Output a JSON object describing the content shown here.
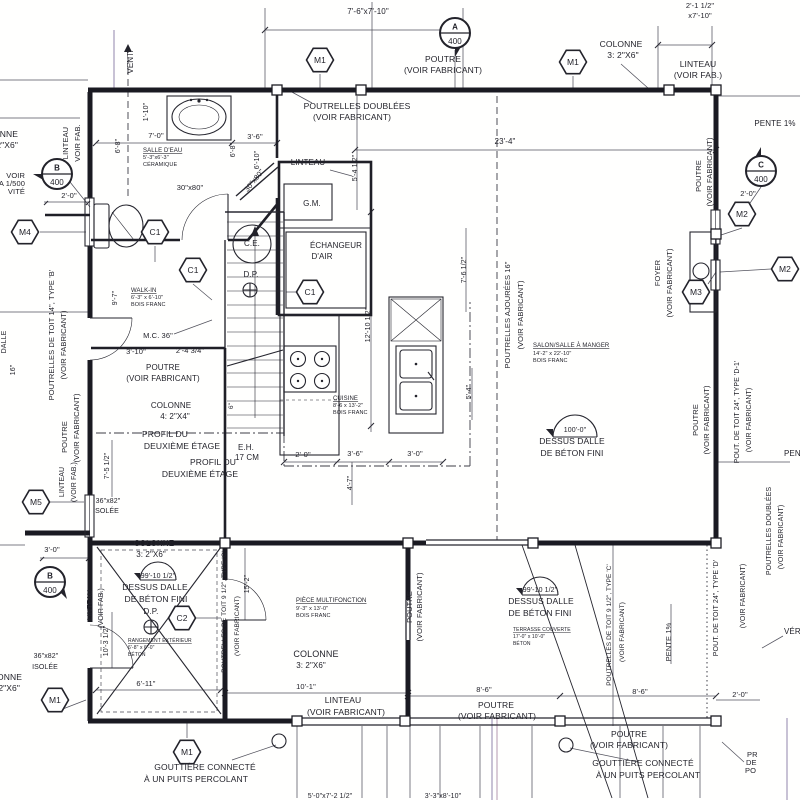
{
  "document": {
    "kind": "architectural-floor-plan",
    "language": "fr",
    "sheet_ref": "400"
  },
  "colors": {
    "ink": "#23232b",
    "paper": "#fffffe",
    "scan_line": "#9184ac"
  },
  "hex_markers": [
    {
      "label": "M1",
      "x": 320,
      "y": 60
    },
    {
      "label": "M1",
      "x": 573,
      "y": 62
    },
    {
      "label": "M4",
      "x": 25,
      "y": 232
    },
    {
      "label": "C1",
      "x": 155,
      "y": 232
    },
    {
      "label": "C1",
      "x": 193,
      "y": 270
    },
    {
      "label": "C1",
      "x": 310,
      "y": 292
    },
    {
      "label": "M5",
      "x": 36,
      "y": 502
    },
    {
      "label": "M2",
      "x": 742,
      "y": 214
    },
    {
      "label": "M2",
      "x": 785,
      "y": 269
    },
    {
      "label": "M3",
      "x": 696,
      "y": 292
    },
    {
      "label": "C2",
      "x": 182,
      "y": 618
    },
    {
      "label": "M1",
      "x": 55,
      "y": 700
    },
    {
      "label": "M1",
      "x": 187,
      "y": 752
    }
  ],
  "section_markers": [
    {
      "letter": "A",
      "number": "400",
      "x": 455,
      "y": 33,
      "ang": 90
    },
    {
      "letter": "B",
      "number": "400",
      "x": 57,
      "y": 174,
      "ang": 180
    },
    {
      "letter": "C",
      "number": "400",
      "x": 761,
      "y": 171,
      "ang": 270
    },
    {
      "letter": "B",
      "number": "400",
      "x": 50,
      "y": 582,
      "ang": 45
    }
  ],
  "labels": [
    {
      "t": "7'-6\"x7'-10\"",
      "x": 368,
      "y": 14,
      "fs": 8,
      "n": "dim-top-opening"
    },
    {
      "t": "POUTRE",
      "x": 443,
      "y": 62,
      "n": "beam-note-top"
    },
    {
      "t": "(VOIR FABRICANT)",
      "x": 443,
      "y": 73
    },
    {
      "t": "POUTRELLES DOUBLÉES",
      "x": 357,
      "y": 109,
      "n": "doubled-joists-note"
    },
    {
      "t": "(VOIR FABRICANT)",
      "x": 352,
      "y": 120
    },
    {
      "t": "COLONNE",
      "x": 621,
      "y": 47,
      "n": "column-note-top"
    },
    {
      "t": "3: 2\"X6\"",
      "x": 623,
      "y": 58
    },
    {
      "t": "LINTEAU",
      "x": 698,
      "y": 67,
      "n": "lintel-note-topright"
    },
    {
      "t": "(VOIR FAB.)",
      "x": 698,
      "y": 78
    },
    {
      "t": "2'-1 1/2\"",
      "x": 700,
      "y": 8,
      "fs": 7.5
    },
    {
      "t": "x7'-10\"",
      "x": 700,
      "y": 18,
      "fs": 7.5
    },
    {
      "t": "PENTE 1%",
      "x": 775,
      "y": 126,
      "fs": 8,
      "n": "slope-note"
    },
    {
      "t": "23'-4\"",
      "x": 505,
      "y": 144,
      "fs": 8
    },
    {
      "t": "VENT.",
      "x": 133,
      "y": 62,
      "r": -90,
      "fs": 8,
      "n": "vent-note"
    },
    {
      "t": "COLONNE",
      "x": 18,
      "y": 137,
      "a": "e"
    },
    {
      "t": "3: 2\"X6\"",
      "x": 18,
      "y": 148,
      "a": "e"
    },
    {
      "t": "LINTEAU",
      "x": 68,
      "y": 143,
      "r": -90,
      "fs": 7.5
    },
    {
      "t": "VOIR FAB.",
      "x": 80,
      "y": 143,
      "r": -90,
      "fs": 7.5
    },
    {
      "t": "VOIR",
      "x": 25,
      "y": 178,
      "a": "e",
      "fs": 7.5
    },
    {
      "t": "A 1/500",
      "x": 25,
      "y": 186,
      "a": "e",
      "fs": 7.5
    },
    {
      "t": "VITÉ",
      "x": 25,
      "y": 194,
      "a": "e",
      "fs": 7.5
    },
    {
      "t": "2'-0\"",
      "x": 69,
      "y": 198,
      "fs": 7.5
    },
    {
      "t": "DALLE",
      "x": 6,
      "y": 342,
      "r": -90,
      "fs": 7
    },
    {
      "t": "16\"",
      "x": 15,
      "y": 370,
      "r": -90,
      "fs": 7
    },
    {
      "t": "POUTRELLES DE TOIT 14\", TYPE 'B'",
      "x": 54,
      "y": 335,
      "r": -90,
      "fs": 7.5,
      "n": "roof-joist-note-left"
    },
    {
      "t": "(VOIR FABRICANT)",
      "x": 66,
      "y": 345,
      "r": -90,
      "fs": 7.5
    },
    {
      "t": "POUTRE",
      "x": 67,
      "y": 437,
      "r": -90,
      "fs": 7.5
    },
    {
      "t": "(VOIR FABRICANT)",
      "x": 79,
      "y": 428,
      "r": -90,
      "fs": 7.5
    },
    {
      "t": "7'-5 1/2\"",
      "x": 109,
      "y": 466,
      "r": -90,
      "fs": 7
    },
    {
      "t": "LINTEAU",
      "x": 64,
      "y": 482,
      "r": -90,
      "fs": 7
    },
    {
      "t": "(VOIR FAB.)",
      "x": 76,
      "y": 482,
      "r": -90,
      "fs": 7
    },
    {
      "t": "36\"x82\"",
      "x": 108,
      "y": 503,
      "fs": 7,
      "n": "door-size-left"
    },
    {
      "t": "ISOLÉE",
      "x": 106,
      "y": 513,
      "fs": 7
    },
    {
      "t": "3'-0\"",
      "x": 52,
      "y": 552,
      "fs": 7.5
    },
    {
      "t": "36\"x82\"",
      "x": 46,
      "y": 658,
      "fs": 7,
      "n": "door-size-left-2"
    },
    {
      "t": "ISOLÉE",
      "x": 45,
      "y": 669,
      "fs": 7
    },
    {
      "t": "COLONNE",
      "x": 22,
      "y": 680,
      "a": "e"
    },
    {
      "t": "3: 2\"X6\"",
      "x": 20,
      "y": 691,
      "a": "e"
    },
    {
      "t": "1'-10\"",
      "x": 148,
      "y": 112,
      "r": -90,
      "fs": 7
    },
    {
      "t": "7'-0\"",
      "x": 156,
      "y": 138,
      "fs": 7.5
    },
    {
      "t": "6'-8\"",
      "x": 120,
      "y": 146,
      "r": -90,
      "fs": 7
    },
    {
      "t": "SALLE D'EAU",
      "x": 143,
      "y": 152,
      "fs": 6,
      "u": 1,
      "a": "s",
      "n": "room-salle-deau"
    },
    {
      "t": "5'-3\"x6'-3\"",
      "x": 143,
      "y": 159,
      "fs": 5.5,
      "a": "s"
    },
    {
      "t": "CÉRAMIQUE",
      "x": 143,
      "y": 166,
      "fs": 5.5,
      "a": "s"
    },
    {
      "t": "30\"x80\"",
      "x": 190,
      "y": 190,
      "fs": 7.5,
      "n": "door-size-bath"
    },
    {
      "t": "3'-6\"",
      "x": 255,
      "y": 139,
      "fs": 7.5
    },
    {
      "t": "6'-8\"",
      "x": 235,
      "y": 150,
      "r": -90,
      "fs": 7
    },
    {
      "t": "6'-10\"",
      "x": 259,
      "y": 160,
      "r": -90,
      "fs": 7
    },
    {
      "t": "30\"x80\"",
      "x": 256,
      "y": 182,
      "r": -51,
      "fs": 7.5,
      "n": "door-size-diagonal"
    },
    {
      "t": "LINTEAU",
      "x": 308,
      "y": 165,
      "fs": 8
    },
    {
      "t": "G.M.",
      "x": 312,
      "y": 206,
      "fs": 8,
      "n": "gm-closet"
    },
    {
      "t": "ÉCHANGEUR",
      "x": 336,
      "y": 248,
      "fs": 8,
      "n": "air-exchanger"
    },
    {
      "t": "D'AIR",
      "x": 322,
      "y": 259,
      "fs": 8
    },
    {
      "t": "C.E.",
      "x": 252,
      "y": 246,
      "fs": 8,
      "n": "water-heater"
    },
    {
      "t": "D.P.",
      "x": 251,
      "y": 277,
      "fs": 8,
      "n": "floor-drain-1"
    },
    {
      "t": "12'-10 1/2\"",
      "x": 370,
      "y": 325,
      "r": -90,
      "fs": 7
    },
    {
      "t": "WALK-IN",
      "x": 131,
      "y": 292,
      "fs": 6,
      "u": 1,
      "a": "s",
      "n": "room-walkin"
    },
    {
      "t": "6'-3\" x 6'-10\"",
      "x": 131,
      "y": 299,
      "fs": 5.5,
      "a": "s"
    },
    {
      "t": "BOIS FRANC",
      "x": 131,
      "y": 306,
      "fs": 5.5,
      "a": "s"
    },
    {
      "t": "9'-7\"",
      "x": 117,
      "y": 298,
      "r": -90,
      "fs": 7
    },
    {
      "t": "M.C. 36\"",
      "x": 158,
      "y": 338,
      "fs": 7.5
    },
    {
      "t": "3'-10\"",
      "x": 136,
      "y": 354,
      "fs": 7.5
    },
    {
      "t": "2'-4 3/4\"",
      "x": 190,
      "y": 353,
      "fs": 7.5
    },
    {
      "t": "POUTRE",
      "x": 163,
      "y": 370,
      "fs": 8
    },
    {
      "t": "(VOIR FABRICANT)",
      "x": 163,
      "y": 381,
      "fs": 8
    },
    {
      "t": "COLONNE",
      "x": 171,
      "y": 408,
      "fs": 8
    },
    {
      "t": "4: 2\"X4\"",
      "x": 175,
      "y": 419,
      "fs": 8
    },
    {
      "t": "PROFIL DU",
      "x": 165,
      "y": 437,
      "fs": 8.5,
      "n": "second-floor-profile-1"
    },
    {
      "t": "DEUXIÈME ÉTAGE",
      "x": 182,
      "y": 449,
      "fs": 8.5
    },
    {
      "t": "PROFIL DU",
      "x": 213,
      "y": 465,
      "fs": 8.5,
      "n": "second-floor-profile-2"
    },
    {
      "t": "DEUXIÈME ÉTAGE",
      "x": 200,
      "y": 477,
      "fs": 8.5
    },
    {
      "t": "E.H.",
      "x": 246,
      "y": 450,
      "fs": 8
    },
    {
      "t": "17 CM",
      "x": 247,
      "y": 460,
      "fs": 8
    },
    {
      "t": "2'-0\"",
      "x": 303,
      "y": 457,
      "fs": 7.5
    },
    {
      "t": "6\"",
      "x": 233,
      "y": 406,
      "r": -90,
      "fs": 6.5
    },
    {
      "t": "5'-4 1/2\"",
      "x": 357,
      "y": 168,
      "r": -90,
      "fs": 7
    },
    {
      "t": "4'-7\"",
      "x": 352,
      "y": 483,
      "r": -90,
      "fs": 7
    },
    {
      "t": "CUISINE",
      "x": 333,
      "y": 400,
      "fs": 6,
      "u": 1,
      "a": "s",
      "n": "room-cuisine"
    },
    {
      "t": "8'-6 x 13'-2\"",
      "x": 333,
      "y": 407,
      "fs": 5.5,
      "a": "s"
    },
    {
      "t": "BOIS FRANC",
      "x": 333,
      "y": 414,
      "fs": 5.5,
      "a": "s"
    },
    {
      "t": "3'-6\"",
      "x": 355,
      "y": 456,
      "fs": 7.5
    },
    {
      "t": "3'-0\"",
      "x": 415,
      "y": 456,
      "fs": 7.5
    },
    {
      "t": "5'-4\"",
      "x": 471,
      "y": 392,
      "r": -90,
      "fs": 7
    },
    {
      "t": "7'-6 1/2\"",
      "x": 466,
      "y": 270,
      "r": -90,
      "fs": 7
    },
    {
      "t": "POUTRELLES AJOURÉES 16\"",
      "x": 510,
      "y": 315,
      "r": -90,
      "fs": 7.5,
      "n": "open-joist-note"
    },
    {
      "t": "(VOIR FABRICANT)",
      "x": 523,
      "y": 315,
      "r": -90,
      "fs": 7.5
    },
    {
      "t": "SALON/SALLE À MANGER",
      "x": 533,
      "y": 347,
      "fs": 6,
      "u": 1,
      "a": "s",
      "n": "room-salon"
    },
    {
      "t": "14'-2\" x 22'-10\"",
      "x": 533,
      "y": 355,
      "fs": 5.5,
      "a": "s"
    },
    {
      "t": "BOIS FRANC",
      "x": 533,
      "y": 362,
      "fs": 5.5,
      "a": "s"
    },
    {
      "t": "100'-0\"",
      "x": 575,
      "y": 432,
      "fs": 7,
      "n": "elevation-salon"
    },
    {
      "t": "DESSUS DALLE",
      "x": 572,
      "y": 444,
      "fs": 8.5
    },
    {
      "t": "DE BÉTON FINI",
      "x": 572,
      "y": 456,
      "fs": 8.5
    },
    {
      "t": "FOYER",
      "x": 660,
      "y": 273,
      "r": -90,
      "fs": 7.5,
      "n": "fireplace-note"
    },
    {
      "t": "(VOIR FABRICANT)",
      "x": 672,
      "y": 283,
      "r": -90,
      "fs": 7.5
    },
    {
      "t": "POUTRE",
      "x": 701,
      "y": 176,
      "r": -90,
      "fs": 7.5
    },
    {
      "t": "(VOIR FABRICANT)",
      "x": 712,
      "y": 172,
      "r": -90,
      "fs": 7.5
    },
    {
      "t": "2'-0\"",
      "x": 748,
      "y": 196,
      "fs": 7.5
    },
    {
      "t": "POUTRE",
      "x": 698,
      "y": 420,
      "r": -90,
      "fs": 7.5
    },
    {
      "t": "(VOIR FABRICANT)",
      "x": 709,
      "y": 420,
      "r": -90,
      "fs": 7.5
    },
    {
      "t": "POUT. DE TOIT 24\", TYPE 'D-1'",
      "x": 739,
      "y": 412,
      "r": -90,
      "fs": 7,
      "n": "roof-beam-note-right"
    },
    {
      "t": "(VOIR FABRICANT)",
      "x": 751,
      "y": 420,
      "r": -90,
      "fs": 7
    },
    {
      "t": "POUTRELLES DOUBLÉES",
      "x": 771,
      "y": 531,
      "r": -90,
      "fs": 7
    },
    {
      "t": "(VOIR FABRICANT)",
      "x": 783,
      "y": 537,
      "r": -90,
      "fs": 7
    },
    {
      "t": "POUT. DE TOIT 24\", TYPE 'D'",
      "x": 718,
      "y": 608,
      "r": -90,
      "fs": 7
    },
    {
      "t": "(VOIR FABRICANT)",
      "x": 745,
      "y": 596,
      "r": -90,
      "fs": 7
    },
    {
      "t": "PENTE 1%",
      "x": 784,
      "y": 456,
      "a": "s",
      "fs": 8
    },
    {
      "t": "PENTE 1%",
      "x": 671,
      "y": 642,
      "r": -90,
      "fs": 7.5
    },
    {
      "t": "VÉRIFIER",
      "x": 784,
      "y": 634,
      "a": "s",
      "fs": 8
    },
    {
      "t": "COLONNE",
      "x": 154,
      "y": 546,
      "fs": 8
    },
    {
      "t": "3: 2\"X6\"",
      "x": 151,
      "y": 557,
      "fs": 8
    },
    {
      "t": "99'-10 1/2\"",
      "x": 158,
      "y": 578,
      "fs": 7,
      "n": "elevation-garage"
    },
    {
      "t": "DESSUS DALLE",
      "x": 155,
      "y": 590,
      "fs": 8.5
    },
    {
      "t": "DE BÉTON FINI",
      "x": 156,
      "y": 602,
      "fs": 8.5
    },
    {
      "t": "D.P.",
      "x": 151,
      "y": 614,
      "fs": 8,
      "n": "floor-drain-2"
    },
    {
      "t": "RANGEMENT EXTÉRIEUR",
      "x": 128,
      "y": 642,
      "fs": 5,
      "u": 1,
      "a": "s",
      "n": "room-rangement"
    },
    {
      "t": "6'-8\" x 6'-0\"",
      "x": 128,
      "y": 649,
      "fs": 5,
      "a": "s"
    },
    {
      "t": "BÉTON",
      "x": 128,
      "y": 656,
      "fs": 5,
      "a": "s"
    },
    {
      "t": "6'-11\"",
      "x": 146,
      "y": 686,
      "fs": 7.5
    },
    {
      "t": "10'-3 1/2\"",
      "x": 108,
      "y": 641,
      "r": -90,
      "fs": 7
    },
    {
      "t": "LINTEAU",
      "x": 92,
      "y": 605,
      "r": -90,
      "fs": 7
    },
    {
      "t": "(VOIR FAB.)",
      "x": 103,
      "y": 608,
      "r": -90,
      "fs": 7
    },
    {
      "t": "15'-2\"",
      "x": 249,
      "y": 584,
      "r": -90,
      "fs": 7
    },
    {
      "t": "POUTRELLES DE TOIT 9 1/2\", TYPE 'C'",
      "x": 226,
      "y": 612,
      "r": -90,
      "fs": 6.5
    },
    {
      "t": "(VOIR FABRICANT)",
      "x": 239,
      "y": 626,
      "r": -90,
      "fs": 6.5
    },
    {
      "t": "PIÈCE MULTIFONCTION",
      "x": 296,
      "y": 602,
      "fs": 6,
      "u": 1,
      "a": "s",
      "n": "room-multifonction"
    },
    {
      "t": "9'-3\" x 13'-0\"",
      "x": 296,
      "y": 610,
      "fs": 5.5,
      "a": "s"
    },
    {
      "t": "BOIS FRANC",
      "x": 296,
      "y": 617,
      "fs": 5.5,
      "a": "s"
    },
    {
      "t": "COLONNE",
      "x": 316,
      "y": 657,
      "fs": 9
    },
    {
      "t": "3: 2\"X6\"",
      "x": 311,
      "y": 668,
      "fs": 8
    },
    {
      "t": "10'-1\"",
      "x": 306,
      "y": 689,
      "fs": 7.5
    },
    {
      "t": "LINTEAU",
      "x": 343,
      "y": 703,
      "fs": 8.5
    },
    {
      "t": "(VOIR FABRICANT)",
      "x": 346,
      "y": 715,
      "fs": 8.5
    },
    {
      "t": "POUTRE",
      "x": 412,
      "y": 607,
      "r": -90,
      "fs": 7.5
    },
    {
      "t": "(VOIR FABRICANT)",
      "x": 422,
      "y": 607,
      "r": -90,
      "fs": 7.5
    },
    {
      "t": "99'-10 1/2\"",
      "x": 540,
      "y": 592,
      "fs": 7,
      "n": "elevation-terrasse"
    },
    {
      "t": "DESSUS DALLE",
      "x": 541,
      "y": 604,
      "fs": 8.5
    },
    {
      "t": "DE BÉTON FINI",
      "x": 540,
      "y": 616,
      "fs": 8.5
    },
    {
      "t": "TERRASSE COUVERTE",
      "x": 513,
      "y": 631,
      "fs": 5,
      "u": 1,
      "a": "s",
      "n": "room-terrasse"
    },
    {
      "t": "17'-0\" x 10'-0\"",
      "x": 513,
      "y": 638,
      "fs": 5,
      "a": "s"
    },
    {
      "t": "BÉTON",
      "x": 513,
      "y": 645,
      "fs": 5,
      "a": "s"
    },
    {
      "t": "POUTRELLES DE TOIT 9 1/2\", TYPE 'C'",
      "x": 611,
      "y": 625,
      "r": -90,
      "fs": 6.5
    },
    {
      "t": "(VOIR FABRICANT)",
      "x": 624,
      "y": 632,
      "r": -90,
      "fs": 6.5
    },
    {
      "t": "8'-6\"",
      "x": 484,
      "y": 692,
      "fs": 7.5
    },
    {
      "t": "8'-6\"",
      "x": 640,
      "y": 694,
      "fs": 7.5
    },
    {
      "t": "2'-0\"",
      "x": 740,
      "y": 697,
      "fs": 7.5
    },
    {
      "t": "POUTRE",
      "x": 496,
      "y": 708,
      "fs": 8.5
    },
    {
      "t": "(VOIR FABRICANT)",
      "x": 497,
      "y": 719,
      "fs": 8.5
    },
    {
      "t": "POUTRE",
      "x": 629,
      "y": 737,
      "fs": 8.5
    },
    {
      "t": "(VOIR FABRICANT)",
      "x": 629,
      "y": 748,
      "fs": 8.5
    },
    {
      "t": "GOUTTIÈRE CONNECTÉ",
      "x": 643,
      "y": 766,
      "fs": 8.5,
      "n": "gutter-note-right"
    },
    {
      "t": "À UN PUITS PERCOLANT",
      "x": 648,
      "y": 778,
      "fs": 8.5
    },
    {
      "t": "GOUTTIÈRE CONNECTÉ",
      "x": 205,
      "y": 770,
      "fs": 8.5,
      "n": "gutter-note-left"
    },
    {
      "t": "À UN PUITS PERCOLANT",
      "x": 196,
      "y": 782,
      "fs": 8.5
    },
    {
      "t": "5'-0\"x7'-2 1/2\"",
      "x": 330,
      "y": 798,
      "fs": 7
    },
    {
      "t": "3'-3\"x8'-10\"",
      "x": 443,
      "y": 798,
      "fs": 7
    },
    {
      "t": "PR",
      "x": 747,
      "y": 757,
      "a": "s",
      "fs": 7.5
    },
    {
      "t": "DE",
      "x": 746,
      "y": 765,
      "a": "s",
      "fs": 7.5
    },
    {
      "t": "PO",
      "x": 745,
      "y": 773,
      "a": "s",
      "fs": 7.5
    }
  ]
}
